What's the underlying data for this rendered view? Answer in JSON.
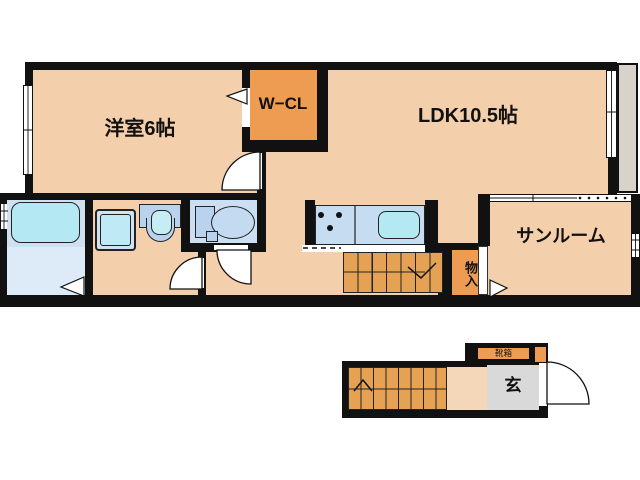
{
  "rooms": {
    "yoshitsu": "洋室6帖",
    "wcl": "W−CL",
    "ldk": "LDK10.5帖",
    "sunroom": "サンルーム",
    "monoire": "物入",
    "genkan": "玄",
    "kutsubako": "靴箱"
  },
  "colors": {
    "wall": "#111111",
    "floor": "#f4cfab",
    "closet": "#ee9c52",
    "stairs": "#e5a254",
    "wetroom": "#cfe0f1",
    "bathfloor": "#dcebf7",
    "fixture": "#b4e9f3",
    "counter": "#c6dcf0",
    "appliance": "#bfeaf5",
    "ceramic": "#b9d3ee",
    "balcony": "#d8d3ca",
    "entry": "#d9d9d9",
    "tan": "#f3d7b8"
  }
}
